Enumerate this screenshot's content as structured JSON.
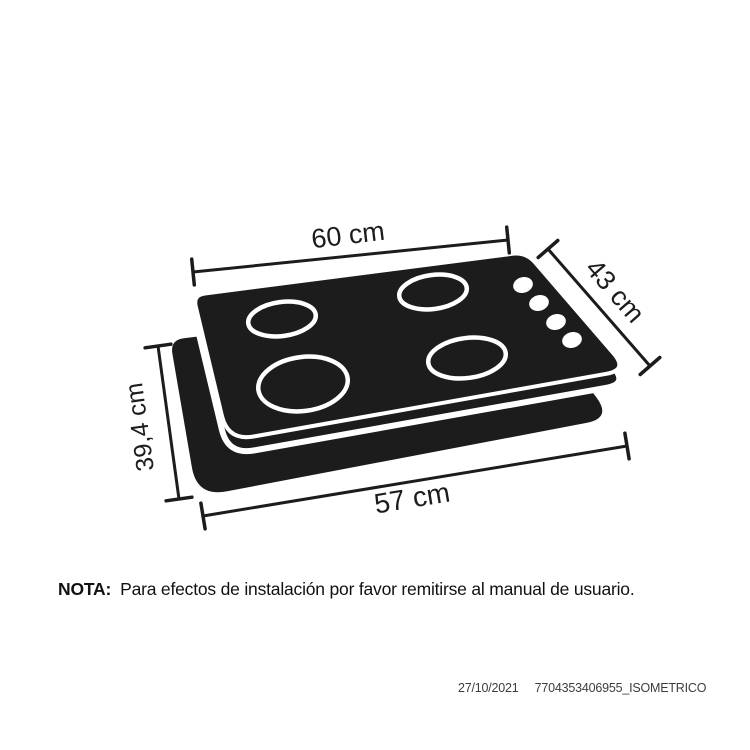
{
  "diagram": {
    "panel_color": "#1c1c1c",
    "line_color": "#1c1c1c",
    "background_color": "#ffffff",
    "burner_count": 4,
    "knob_count": 4,
    "dimensions": {
      "top_width": "60 cm",
      "side_depth": "43 cm",
      "left_depth": "39,4 cm",
      "bottom_width": "57 cm"
    }
  },
  "note": {
    "label": "NOTA:",
    "text": "Para efectos de instalación por favor remitirse al manual de usuario."
  },
  "footer": {
    "date": "27/10/2021",
    "reference": "7704353406955_ISOMETRICO"
  }
}
